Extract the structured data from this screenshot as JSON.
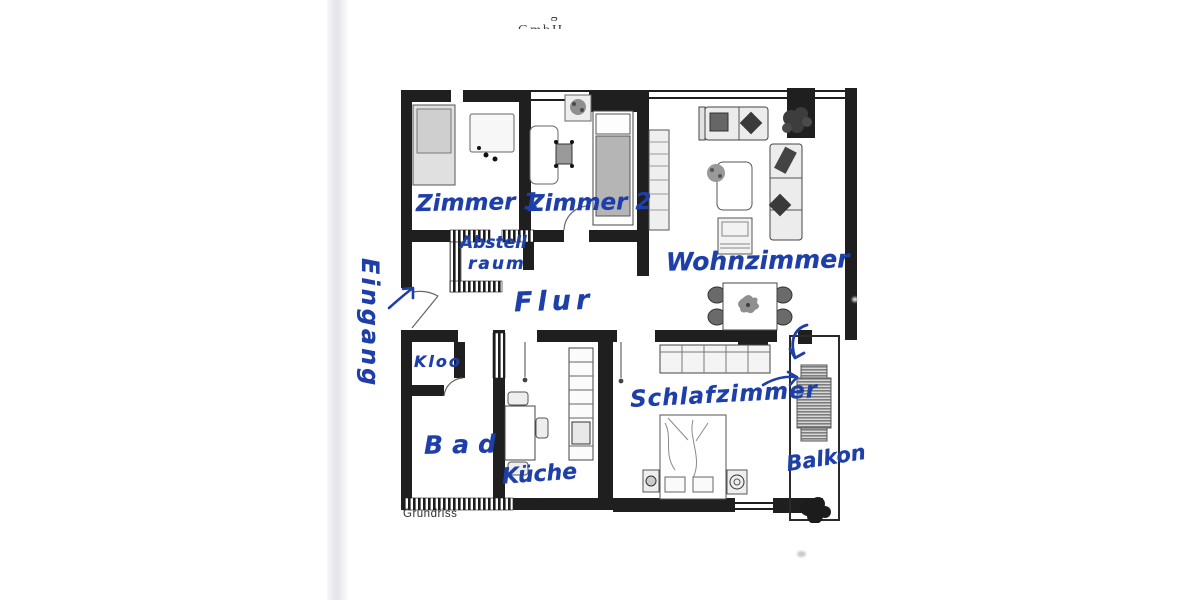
{
  "page": {
    "header_fragment": "·· ·g······ ––– ·· ·········· GmbH",
    "caption": "Grundriss"
  },
  "colors": {
    "ink_blue": "#1e3ea8",
    "wall_black": "#1f1f1f",
    "paper": "#ffffff"
  },
  "floorplan": {
    "rooms": {
      "eingang": "Eingang",
      "zimmer1": "Zimmer 1",
      "zimmer2": "Zimmer 2",
      "abstell_line1": "Abstell",
      "abstell_line2": "raum",
      "wohnzimmer": "Wohnzimmer",
      "flur": "Flur",
      "kloo": "Kloo",
      "bad": "Bad",
      "kueche": "Küche",
      "schlafzimmer": "Schlafzimmer",
      "balkon": "Balkon"
    },
    "icons": {
      "entry_arrow": "↗",
      "balcony_down_arrow": "↓",
      "balcony_right_arrow": "→"
    }
  }
}
